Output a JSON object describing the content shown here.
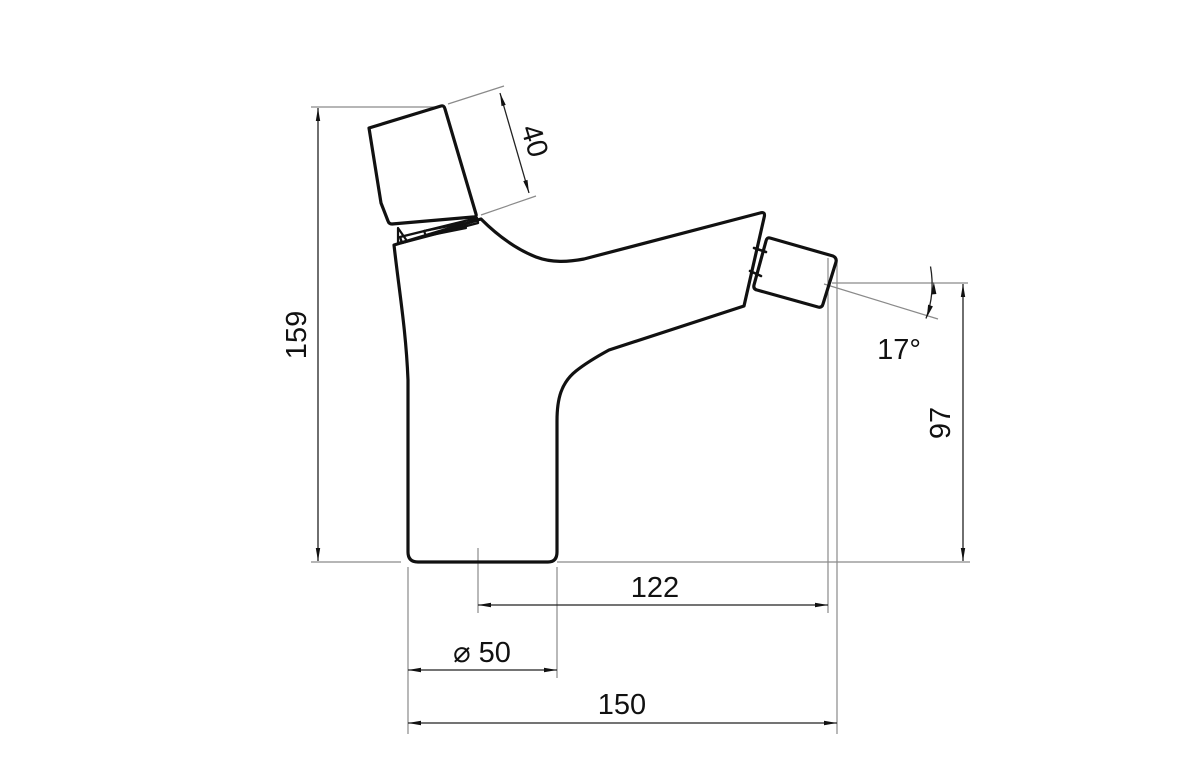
{
  "drawing": {
    "kind": "technical-dimension-drawing",
    "subject": "single-lever-mixer-faucet-side-view",
    "background_color": "#ffffff",
    "outline_color": "#111111",
    "dimension_line_color": "#222222",
    "extension_line_color": "#8a8a8a",
    "dimensions": {
      "total_height": "159",
      "handle_length": "40",
      "outlet_angle": "17°",
      "outlet_height": "97",
      "outlet_reach": "122",
      "base_diameter": "⌀ 50",
      "total_depth": "150"
    }
  }
}
